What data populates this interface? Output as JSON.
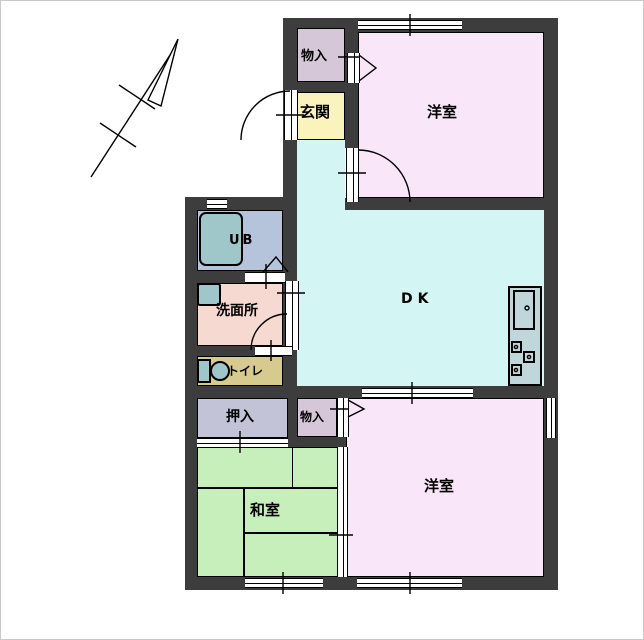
{
  "rooms": {
    "storage_top": {
      "label": "物入"
    },
    "entrance": {
      "label": "玄関"
    },
    "western_top": {
      "label": "洋室"
    },
    "dk": {
      "label": "DK"
    },
    "unit_bath": {
      "label": "UB"
    },
    "washroom": {
      "label": "洗面所"
    },
    "toilet": {
      "label": "トイレ"
    },
    "closet": {
      "label": "押入"
    },
    "storage_bottom": {
      "label": "物入"
    },
    "japanese_room": {
      "label": "和室"
    },
    "western_bottom": {
      "label": "洋室"
    }
  },
  "colors": {
    "wall": "#3d3d3d",
    "western": "#f9e6f8",
    "dk": "#d3f5f4",
    "entrance": "#faf3bb",
    "storage": "#d5c6d8",
    "unit_bath": "#b5c4db",
    "washroom": "#f6d9d1",
    "toilet": "#d7ca8f",
    "closet": "#c2c3d6",
    "japanese": "#c6efbb",
    "fixture": "#9fc6c8",
    "kitchen": "#bfd6da",
    "line": "#000000"
  }
}
